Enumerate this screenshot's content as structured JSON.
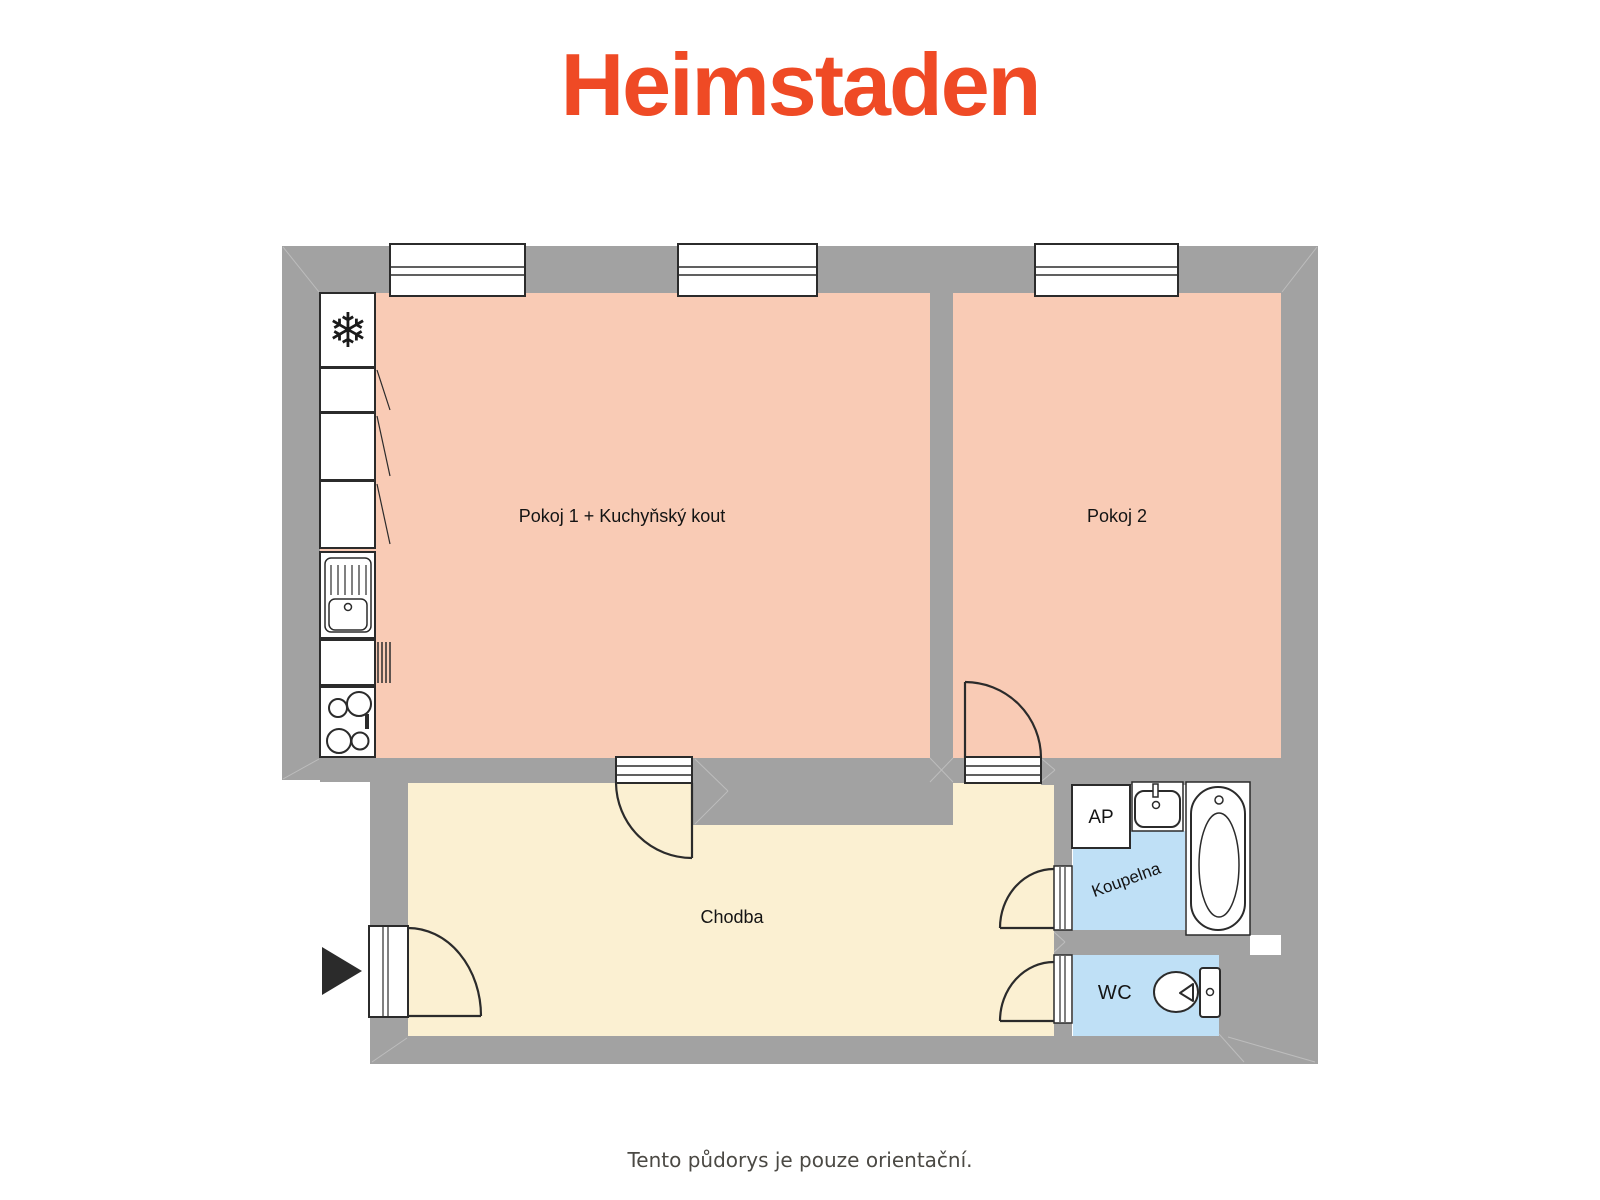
{
  "brand": {
    "logo_text": "Heimstaden"
  },
  "caption": {
    "text": "Tento půdorys je pouze orientační."
  },
  "labels": {
    "pokoj1": "Pokoj 1 + Kuchyňský kout",
    "pokoj2": "Pokoj 2",
    "chodba": "Chodba",
    "koupelna": "Koupelna",
    "wc": "WC",
    "ap": "AP"
  },
  "icons": {
    "snowflake": "❄",
    "fixture_names": [
      "refrigerator",
      "kitchen-cabinet",
      "kitchen-sink",
      "stove",
      "radiator",
      "window",
      "door-swing",
      "entry-arrow",
      "washing-machine-space",
      "washbasin",
      "bathtub",
      "toilet"
    ]
  },
  "colors": {
    "wall": "#A2A2A2",
    "pink": "#F9CBB5",
    "cream": "#FBF0D2",
    "blue": "#BFE0F6",
    "white": "#FFFFFF",
    "line": "#2B2B2B",
    "joint": "#BDBDBD",
    "brand": "#EF4A25",
    "caption": "#4B4944",
    "text": "#141414"
  }
}
